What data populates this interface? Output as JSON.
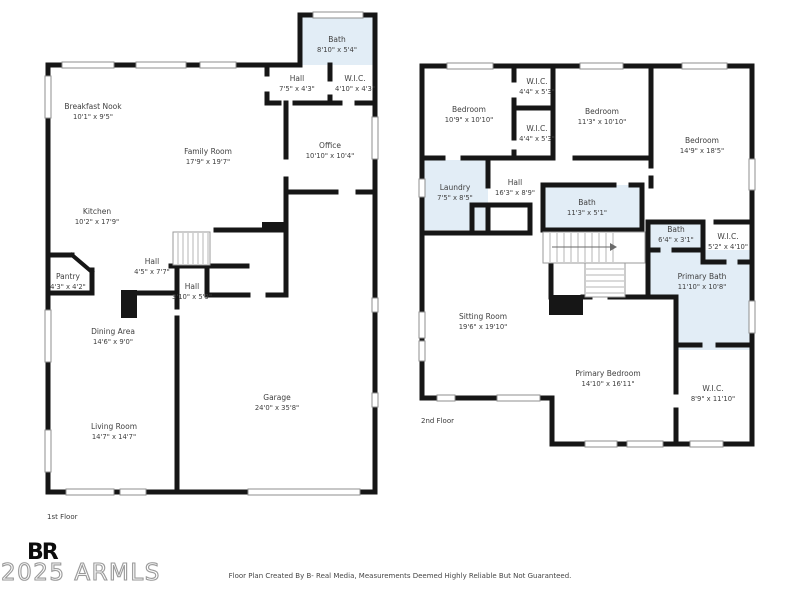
{
  "colors": {
    "wall": "#161616",
    "wet_room_fill": "#e2edf6",
    "label": "#3f3f3f"
  },
  "floors": [
    {
      "label": "1st Floor",
      "rooms": [
        {
          "name": "Bath",
          "dims": "8'10\" x 5'4\""
        },
        {
          "name": "Hall",
          "dims": "7'5\" x 4'3\""
        },
        {
          "name": "W.I.C.",
          "dims": "4'10\" x 4'3\""
        },
        {
          "name": "Office",
          "dims": "10'10\" x 10'4\""
        },
        {
          "name": "Breakfast Nook",
          "dims": "10'1\" x 9'5\""
        },
        {
          "name": "Family Room",
          "dims": "17'9\" x 19'7\""
        },
        {
          "name": "Kitchen",
          "dims": "10'2\" x 17'9\""
        },
        {
          "name": "Pantry",
          "dims": "4'3\" x 4'2\""
        },
        {
          "name": "Hall",
          "dims": "4'5\" x 7'7\""
        },
        {
          "name": "Hall",
          "dims": "3'10\" x 5'9\""
        },
        {
          "name": "Dining Area",
          "dims": "14'6\" x 9'0\""
        },
        {
          "name": "Living Room",
          "dims": "14'7\" x 14'7\""
        },
        {
          "name": "Garage",
          "dims": "24'0\" x 35'8\""
        }
      ]
    },
    {
      "label": "2nd Floor",
      "rooms": [
        {
          "name": "Bedroom",
          "dims": "10'9\" x 10'10\""
        },
        {
          "name": "W.I.C.",
          "dims": "4'4\" x 5'3\""
        },
        {
          "name": "W.I.C.",
          "dims": "4'4\" x 5'3\""
        },
        {
          "name": "Bedroom",
          "dims": "11'3\" x 10'10\""
        },
        {
          "name": "Bedroom",
          "dims": "14'9\" x 18'5\""
        },
        {
          "name": "Laundry",
          "dims": "7'5\" x 8'5\""
        },
        {
          "name": "Hall",
          "dims": "16'3\" x 8'9\""
        },
        {
          "name": "Bath",
          "dims": "11'3\" x 5'1\""
        },
        {
          "name": "Bath",
          "dims": "6'4\" x 3'1\""
        },
        {
          "name": "W.I.C.",
          "dims": "5'2\" x 4'10\""
        },
        {
          "name": "Primary Bath",
          "dims": "11'10\" x 10'8\""
        },
        {
          "name": "Sitting Room",
          "dims": "19'6\" x 19'10\""
        },
        {
          "name": "Primary Bedroom",
          "dims": "14'10\" x 16'11\""
        },
        {
          "name": "W.I.C.",
          "dims": "8'9\" x 11'10\""
        }
      ]
    }
  ],
  "branding": {
    "logo_text": "BR",
    "watermark": "2025 ARMLS"
  },
  "footer": {
    "credit": "Floor Plan Created By B- Real Media, Measurements Deemed Highly Reliable But Not Guaranteed."
  }
}
